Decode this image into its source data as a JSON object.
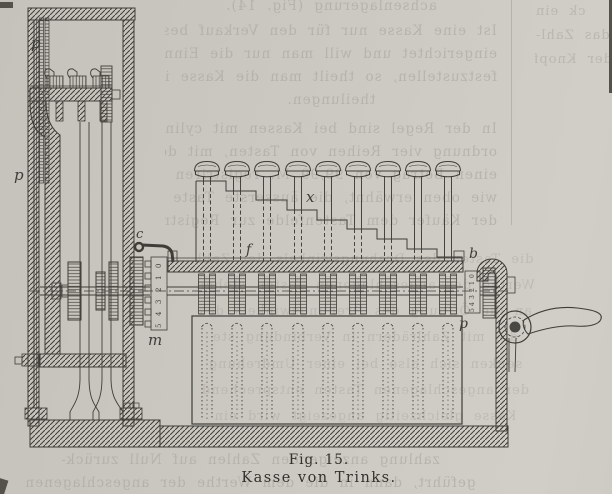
{
  "figure": {
    "caption_fig": "Fig. 15.",
    "caption_title": "Kasse von Trinks.",
    "labels": {
      "p_top": "p",
      "p_left": "p",
      "c": "c",
      "x": "x",
      "f": "f",
      "b": "b",
      "m": "m",
      "p_right": "p"
    },
    "left_scale_digits": [
      "0",
      "1",
      "2",
      "3",
      "4",
      "5"
    ],
    "right_scale_digits": [
      "0",
      "1",
      "2",
      "3",
      "4",
      "5"
    ],
    "colors": {
      "paper": "#cbc8c1",
      "ink": "#3f3d37",
      "bleed_text": "#a9a69f"
    }
  },
  "bleedthrough": {
    "top_lines": [
      "achsenlagerung (Fig. 14).",
      "Ist eine Kasse nur für den Verkauf bestimmter Waaren",
      "eingerichtet und will man nur die Einnahmen dieser Waaren",
      "festzustellen, so theilt man die Kasse in verschiedene Ab-",
      "theilungen.",
      "In der Regel sind bei Kassen mit cylindrischen R",
      "ordnung vier Reihen von Tasten, mit deren Hilfe man",
      "einen Betrag von 99,99 M. registriren kann",
      "wie oben erwähnt, die äusserste Taste eine",
      "der Käufer dem Tastenfelde zur Registrirung der"
    ],
    "middle_lines": [
      "die Tasten des Drehungswinkels der Zahl",
      "Werthe der angeschlagenen Tasten stehen",
      "an die Öffnung des Drehungswinkels des",
      "die mit Zahlrädern in Verbindung ste",
      "senken sich also bei einer Umdrehung",
      "der angeschlagenen Tasten entsprechend",
      "Kasse gleichzeitig angezeigt wird ein"
    ],
    "bottom_lines": [
      "zahlung anzeigenden Zahlen auf Null zurück-",
      "geführt, dann in die dem Werthe der angeschlagenen"
    ],
    "margin_lines": [
      "ck ein",
      "das Zahl-",
      "der Knopf"
    ]
  }
}
